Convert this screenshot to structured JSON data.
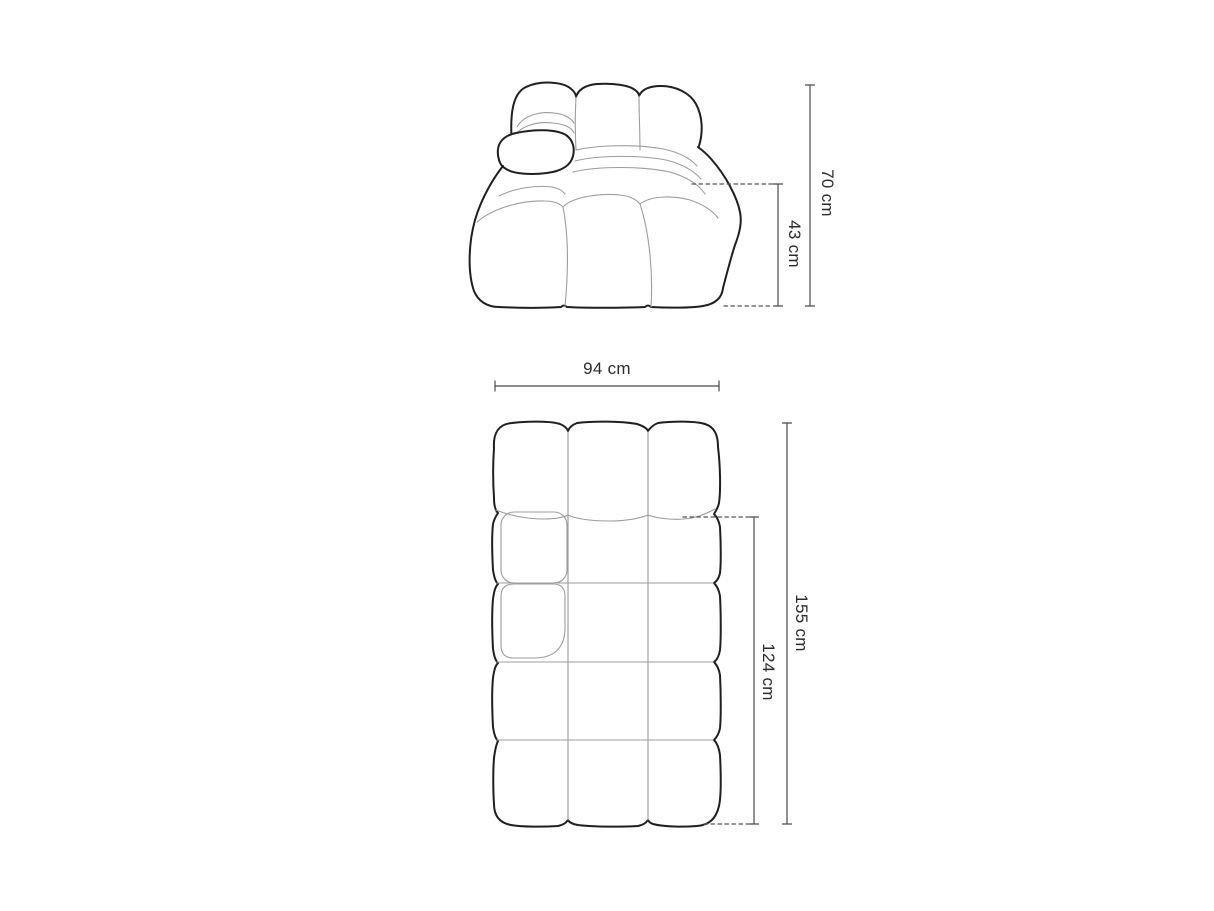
{
  "colors": {
    "background": "#ffffff",
    "outline": "#1f1f1f",
    "seam": "#9c9c9c",
    "dimension_line": "#4a4a4a",
    "label_text": "#2b2b2b"
  },
  "diagram": {
    "views": {
      "front": {
        "dimensions": {
          "total_height": {
            "label": "70 cm",
            "value": 70,
            "unit": "cm",
            "orientation": "vertical"
          },
          "seat_height": {
            "label": "43 cm",
            "value": 43,
            "unit": "cm",
            "orientation": "vertical"
          }
        }
      },
      "top": {
        "dimensions": {
          "width": {
            "label": "94 cm",
            "value": 94,
            "unit": "cm",
            "orientation": "horizontal"
          },
          "total_depth": {
            "label": "155 cm",
            "value": 155,
            "unit": "cm",
            "orientation": "vertical"
          },
          "seat_depth": {
            "label": "124 cm",
            "value": 124,
            "unit": "cm",
            "orientation": "vertical"
          }
        }
      }
    }
  }
}
